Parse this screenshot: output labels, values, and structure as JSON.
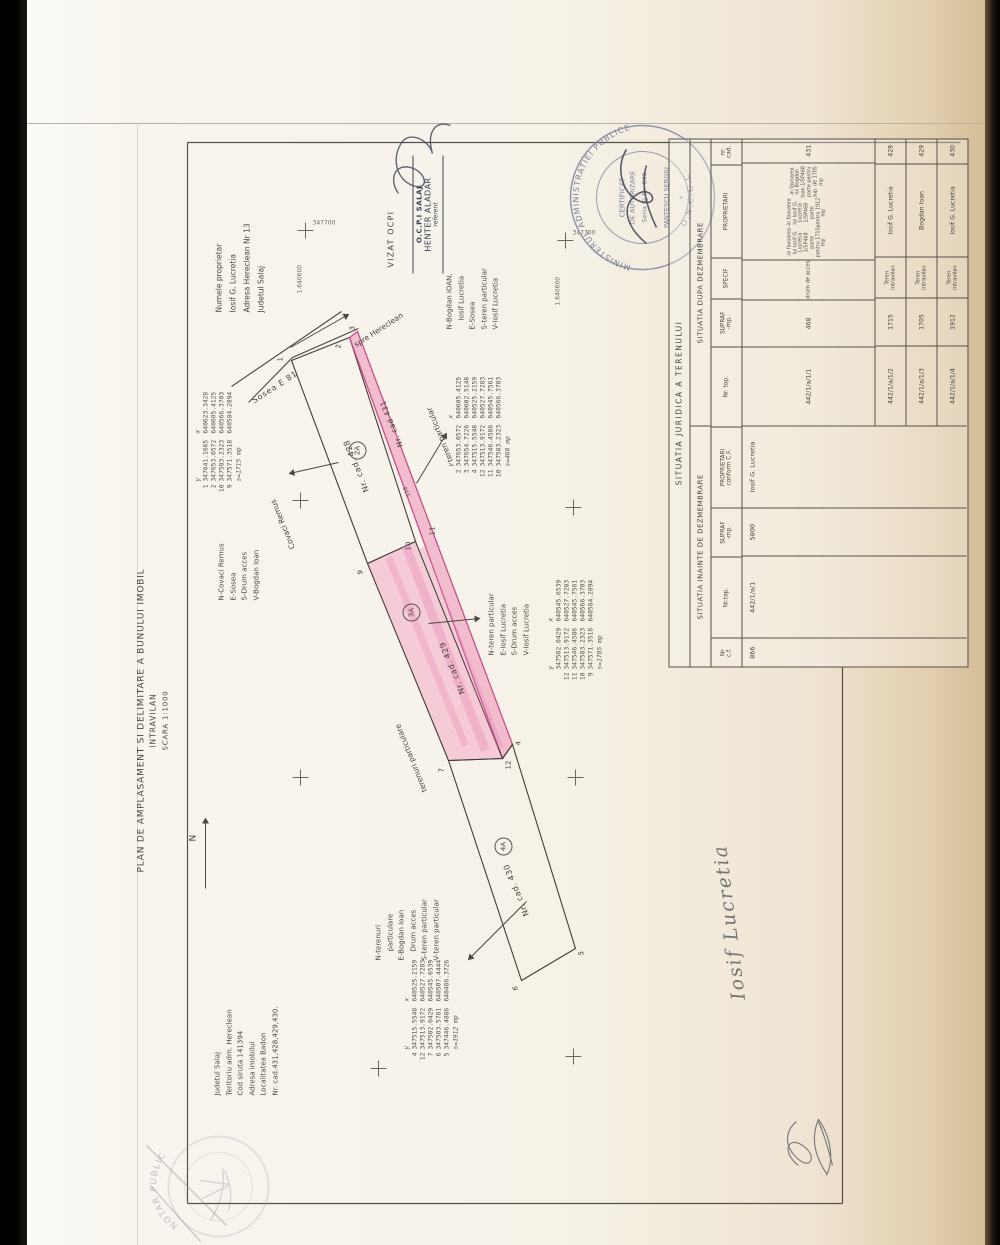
{
  "document": {
    "title": "PLAN DE AMPLASAMENT SI DELIMITARE A BUNULUI IMOBIL",
    "subtitle": "INTRAVILAN",
    "scale": "SCARA 1:1000",
    "north_label": "N"
  },
  "location": {
    "line1": "Judetul Salaj",
    "line2": "Teritoriu adm. Hereclean",
    "line3": "Cod siruta 141394",
    "line4": "Adresa imobilui",
    "line5": "Localitatea Badon",
    "line6": "Nr. cad.431,428,429,430."
  },
  "owner": {
    "line1": "Numele proprietar",
    "line2": "Iosif G. Lucretia",
    "line3": "Adresa Hereclean Nr 13",
    "line4": "Judetul Salaj"
  },
  "road": {
    "name": "Sosea E 81",
    "direction_note": "spre Hereclean"
  },
  "grid": {
    "easting_label": "1.640600",
    "northing_label": "347700"
  },
  "coord_headers": {
    "y": "y",
    "x": "x"
  },
  "annotations": {
    "covaci": "Covaci Remus",
    "teren_particular": "teren particular",
    "terenuri_particulare": "terenuri particulare",
    "dim_118": "118"
  },
  "corner_points": {
    "p1": "1",
    "p2": "2",
    "p3": "3",
    "p4": "4",
    "p5": "5",
    "p6": "6",
    "p7": "7",
    "p9": "9",
    "p10": "10",
    "p11": "11",
    "p12": "12"
  },
  "parcels": {
    "p428": {
      "cad_label": "Nr. cad. 428",
      "zone_label": "2A",
      "n1": "N-Covaci Remus",
      "n2": "E-Sosea",
      "n3": "S-Drum acces",
      "n4": "V-Bogdan Ioan",
      "coords": [
        [
          "1",
          "347641.1665",
          "640623.3428"
        ],
        [
          "2",
          "347653.0572",
          "640605.4125"
        ],
        [
          "10",
          "347583.2323",
          "640566.3703"
        ],
        [
          "9",
          "347571.3518",
          "640584.2894"
        ]
      ],
      "area": "s=1715 mp"
    },
    "p431": {
      "cad_label": "Nr. cad 431",
      "n1": "N-Bogdan IOAN,",
      "n2": "Iosif Lucretia",
      "n3": "E-Sosea",
      "n4": "S-teren particular",
      "n5": "V-Iosif Lucretia",
      "coords": [
        [
          "2",
          "347653.0572",
          "640605.4125"
        ],
        [
          "3",
          "347654.7226",
          "640602.5148"
        ],
        [
          "4",
          "347515.5548",
          "640525.2159"
        ],
        [
          "12",
          "347513.9172",
          "640527.7283"
        ],
        [
          "11",
          "347546.4586",
          "640545.7561"
        ],
        [
          "10",
          "347583.2323",
          "640566.3703"
        ]
      ],
      "area": "s=468 mp"
    },
    "p429": {
      "cad_label": "Nr. cad. 429",
      "zone_label": "3A",
      "n1": "N-teren particular",
      "n2": "E-Iosif Lucretia",
      "n3": "S-Drum acces",
      "n4": "V-Iosif Lucretia",
      "coords": [
        [
          "7",
          "347502.0429",
          "640545.6539"
        ],
        [
          "12",
          "347513.9172",
          "640527.7283"
        ],
        [
          "11",
          "347546.4586",
          "640545.7561"
        ],
        [
          "10",
          "347583.2323",
          "640566.3703"
        ],
        [
          "9",
          "347571.3518",
          "640584.2894"
        ]
      ],
      "area": "s=1705 mp"
    },
    "p430": {
      "cad_label": "Nr. cad. 430",
      "zone_label": "4A",
      "n1": "N-terenuri",
      "n2": "particulare",
      "n3": "E-Bogdan Ioan",
      "n4": "Drum acces",
      "n5": "S-teren particular",
      "n6": "V-teren particular",
      "coords": [
        [
          "4",
          "347515.5548",
          "640525.2159"
        ],
        [
          "12",
          "347513.9172",
          "640527.7283"
        ],
        [
          "7",
          "347502.0429",
          "640545.6539"
        ],
        [
          "6",
          "347503.5781",
          "640507.4444"
        ],
        [
          "5",
          "347446.4886",
          "640486.3726"
        ]
      ],
      "area": "s=1912 mp"
    }
  },
  "stamps": {
    "vizat": "VIZAT OCPI",
    "ocpi": {
      "line1": "O.C.P.I SALAJ",
      "line2": "HENTER ALADAR",
      "line3": "referent"
    },
    "round": {
      "arc_top": "MINISTERUL ADMINISTRATIEI PUBLICE",
      "arc_bottom": "O.N.C.G.C.",
      "inner1": "CERTIFICAT",
      "inner2": "DE AUTORIZARE",
      "inner3": "Seria SJ Nr. 040",
      "inner4": "PANTESCU SERGIU"
    },
    "notar": "NOTAR PUBLIC"
  },
  "signature_name": "Iosif Lucretia",
  "table": {
    "title": "SITUATIA JURIDICA A TERENULUI",
    "before": {
      "section": "SITUATIA INAINTE DE DEZMEMBRARE",
      "h1": "Nr\nc.f.",
      "h2": "Nr.top.",
      "h3": "SUPRAF\n-mp.",
      "h4": "PROPRIETARI\nconform C.F.",
      "row": {
        "cf": "866",
        "nrtop": "442/1/a/1",
        "supraf": "5800",
        "propr": "Iosif G. Lucretia"
      }
    },
    "after": {
      "section": "SITUATIA DUPA DEZMEMBRARE",
      "h1": "Nr. top.",
      "h2": "SUPRAF\n-mp.",
      "h3": "SPECIF",
      "h4": "PROPRIETARI",
      "h5": "nr.\ncad.",
      "rows": [
        {
          "nrtop": "442/1/a/1/1",
          "supraf": "468",
          "specif": "drum de acces",
          "propr": "",
          "cad": "431"
        },
        {
          "nrtop": "442/1/a/1/2",
          "supraf": "1715",
          "specif": "Teren intravilan",
          "propr": "Iosif G. Lucretia",
          "cad": "428"
        },
        {
          "nrtop": "442/1/a/1/3",
          "supraf": "1705",
          "specif": "Teren intravilan",
          "propr": "Bogdan Ioan",
          "cad": "429"
        },
        {
          "nrtop": "442/1/a/1/4",
          "supraf": "1912",
          "specif": "Teren intravilan",
          "propr": "Iosif G. Lucretia",
          "cad": "430"
        }
      ],
      "grant1": "-in favoarea lui Iosif G. Lucretia 1/5P468 parte pentru 1715 mp",
      "grant2": "-in favoarea lui Iosif G. Lucretia 1/5P468 parte pentru 1912 mp",
      "grant3": "-in favoarea lui Bogdan Ioan 1/5P468 parte pentru sup. de 1705 mp"
    }
  }
}
